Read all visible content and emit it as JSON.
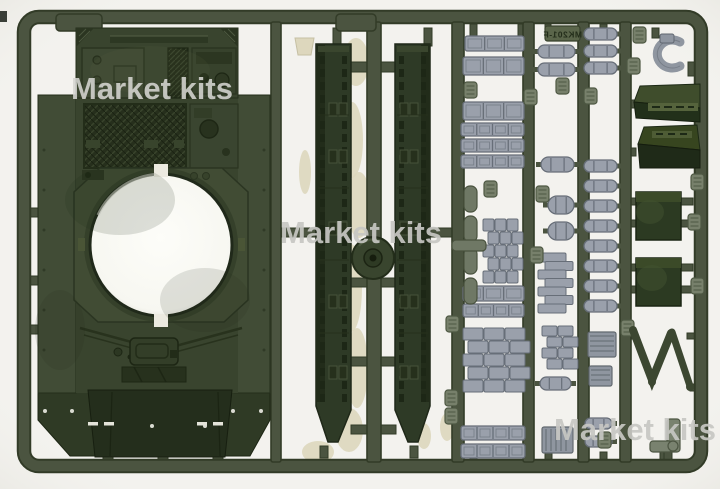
{
  "meta": {
    "description": "Product photo of an olive-green injection-molded plastic model tank sprue: upper hull, two side skirts, idler wheel disc, track-link strips, cylinders, stowage boxes and small detail parts on a rectangular runner frame",
    "sprue_code_visible": "MK201-F"
  },
  "watermarks": [
    {
      "text": "Market kits",
      "x": 152,
      "y": 99,
      "size": 31,
      "color": "#d6d6d2",
      "opacity": 0.88
    },
    {
      "text": "Market kits",
      "x": 361,
      "y": 243,
      "size": 31,
      "color": "#c7c7c3",
      "opacity": 0.92
    },
    {
      "text": "Market kits",
      "x": 635,
      "y": 440,
      "size": 31,
      "color": "#c7c7c3",
      "opacity": 0.92
    }
  ],
  "code_tag": {
    "text": "MK201-F",
    "plate": [
      545,
      26,
      35,
      15
    ]
  },
  "palette": {
    "bg": "#f3f2ee",
    "runner": "#4b5440",
    "runnerEdge": "#323b27",
    "hull": "#39442e",
    "fender": "#414c36",
    "hullDark": "#2c3621",
    "hullDarker": "#232d1b",
    "plate": "#414c34",
    "skirt": "#2e3a26",
    "skirtRail": "#222c1a",
    "gray": "#9aa0ab",
    "grayEdge": "#676e78",
    "grayGreen": "#77806b",
    "grayGreenEdge": "#4e5843",
    "capsule": "#6f7865",
    "boxTop": "#3f4d2c",
    "boxFront": "#22301a",
    "boxFlat": "#2c3a22",
    "beige": "#ddd7bd",
    "hole": "#fbfbf6",
    "disc": "#39452e"
  },
  "layout": {
    "frame": [
      24,
      17,
      677,
      449,
      15
    ],
    "runners": [
      [
        271,
        10
      ],
      [
        367,
        14
      ],
      [
        452,
        12
      ],
      [
        523,
        11
      ],
      [
        578,
        11
      ],
      [
        620,
        11
      ]
    ],
    "sleeves": [
      [
        56,
        14,
        46,
        17
      ],
      [
        336,
        14,
        40,
        17
      ]
    ],
    "edge_tab": [
      0,
      11,
      7,
      11
    ],
    "gates": [
      [
        345,
        62,
        56,
        10
      ],
      [
        333,
        28,
        8,
        18
      ],
      [
        424,
        28,
        8,
        18
      ],
      [
        280,
        228,
        37,
        9
      ],
      [
        429,
        228,
        24,
        9
      ],
      [
        351,
        278,
        17,
        9
      ],
      [
        380,
        278,
        16,
        9
      ],
      [
        351,
        357,
        17,
        9
      ],
      [
        380,
        357,
        16,
        9
      ],
      [
        351,
        425,
        17,
        9
      ],
      [
        380,
        425,
        16,
        9
      ],
      [
        470,
        24,
        7,
        13
      ],
      [
        518,
        24,
        7,
        13
      ],
      [
        545,
        24,
        6,
        8
      ],
      [
        600,
        24,
        7,
        8
      ],
      [
        652,
        28,
        7,
        10
      ],
      [
        103,
        450,
        10,
        9
      ],
      [
        158,
        450,
        10,
        9
      ],
      [
        213,
        450,
        10,
        9
      ],
      [
        320,
        446,
        8,
        12
      ],
      [
        410,
        446,
        8,
        12
      ],
      [
        470,
        452,
        7,
        8
      ],
      [
        545,
        452,
        7,
        8
      ],
      [
        600,
        452,
        7,
        8
      ],
      [
        660,
        452,
        7,
        8
      ],
      [
        28,
        208,
        12,
        9
      ],
      [
        28,
        276,
        12,
        9
      ],
      [
        28,
        325,
        12,
        9
      ],
      [
        264,
        208,
        10,
        9
      ],
      [
        264,
        276,
        10,
        9
      ],
      [
        264,
        326,
        10,
        9
      ],
      [
        624,
        100,
        12,
        8
      ],
      [
        624,
        148,
        12,
        8
      ],
      [
        626,
        198,
        10,
        7
      ],
      [
        626,
        220,
        10,
        7
      ],
      [
        626,
        264,
        10,
        7
      ],
      [
        626,
        286,
        10,
        7
      ],
      [
        681,
        198,
        12,
        7
      ],
      [
        681,
        220,
        12,
        7
      ],
      [
        681,
        264,
        12,
        7
      ],
      [
        681,
        286,
        12,
        7
      ],
      [
        687,
        333,
        12,
        6
      ],
      [
        622,
        332,
        12,
        7
      ],
      [
        664,
        452,
        8,
        9
      ],
      [
        690,
        384,
        8,
        7
      ],
      [
        688,
        96,
        9,
        7
      ],
      [
        688,
        62,
        12,
        14
      ]
    ],
    "track_strips": [
      [
        465,
        36,
        59,
        15,
        3
      ],
      [
        463,
        57,
        61,
        18,
        3
      ],
      [
        463,
        102,
        61,
        18,
        3
      ],
      [
        461,
        123,
        63,
        13,
        4
      ],
      [
        461,
        139,
        63,
        13,
        4
      ],
      [
        461,
        155,
        63,
        13,
        4
      ],
      [
        463,
        286,
        61,
        15,
        3
      ],
      [
        463,
        304,
        61,
        13,
        4
      ],
      [
        461,
        426,
        64,
        14,
        4
      ],
      [
        461,
        444,
        64,
        14,
        4
      ]
    ],
    "grid_stacks": [
      [
        483,
        219,
        3,
        5,
        11,
        12
      ],
      [
        463,
        328,
        3,
        5,
        20,
        12
      ],
      [
        542,
        326,
        2,
        4,
        15,
        10
      ]
    ],
    "piles": [
      [
        538,
        253,
        7,
        28,
        9
      ]
    ],
    "cylinders": [
      [
        538,
        45,
        37,
        13
      ],
      [
        538,
        63,
        37,
        13
      ],
      [
        541,
        157,
        33,
        15
      ],
      [
        548,
        196,
        26,
        18
      ],
      [
        548,
        222,
        26,
        18
      ],
      [
        540,
        377,
        31,
        13
      ],
      [
        584,
        28,
        33,
        12
      ],
      [
        584,
        45,
        33,
        12
      ],
      [
        584,
        62,
        33,
        12
      ],
      [
        584,
        160,
        33,
        12
      ],
      [
        584,
        180,
        33,
        12
      ],
      [
        584,
        200,
        33,
        12
      ],
      [
        584,
        220,
        33,
        12
      ],
      [
        584,
        240,
        33,
        12
      ],
      [
        584,
        260,
        33,
        12
      ],
      [
        584,
        280,
        33,
        12
      ],
      [
        584,
        300,
        33,
        12
      ],
      [
        585,
        418,
        27,
        11
      ],
      [
        585,
        436,
        27,
        11
      ]
    ],
    "capsules": [
      [
        464,
        186
      ],
      [
        464,
        216
      ],
      [
        464,
        248
      ],
      [
        464,
        278
      ]
    ],
    "crossbar": [
      452,
      240,
      34,
      11
    ],
    "small_boxes": [
      [
        588,
        332,
        28,
        25,
        "h"
      ],
      [
        589,
        366,
        23,
        20,
        "h"
      ],
      [
        542,
        427,
        31,
        26,
        "v"
      ]
    ],
    "tags": [
      [
        464,
        82
      ],
      [
        524,
        89
      ],
      [
        556,
        78
      ],
      [
        536,
        186
      ],
      [
        584,
        88
      ],
      [
        530,
        247
      ],
      [
        446,
        316
      ],
      [
        445,
        390
      ],
      [
        445,
        408
      ],
      [
        598,
        432
      ],
      [
        621,
        320
      ],
      [
        627,
        58
      ],
      [
        691,
        174
      ],
      [
        691,
        278
      ],
      [
        633,
        27
      ],
      [
        484,
        181
      ],
      [
        688,
        214
      ]
    ],
    "beige_blobs": [
      [
        356,
        62,
        13,
        24
      ],
      [
        352,
        140,
        11,
        38
      ],
      [
        359,
        205,
        12,
        33
      ],
      [
        351,
        288,
        11,
        44
      ],
      [
        357,
        368,
        11,
        40
      ],
      [
        349,
        430,
        14,
        22
      ],
      [
        318,
        452,
        16,
        11
      ],
      [
        305,
        172,
        6,
        22
      ],
      [
        424,
        436,
        7,
        13
      ],
      [
        447,
        427,
        7,
        14
      ]
    ],
    "beige_cup": [
      295,
      38,
      19,
      17
    ],
    "skirts": [
      {
        "x": 316,
        "mirror": false
      },
      {
        "x": 395,
        "mirror": true
      }
    ],
    "disc": {
      "cx": 373,
      "cy": 258
    }
  }
}
